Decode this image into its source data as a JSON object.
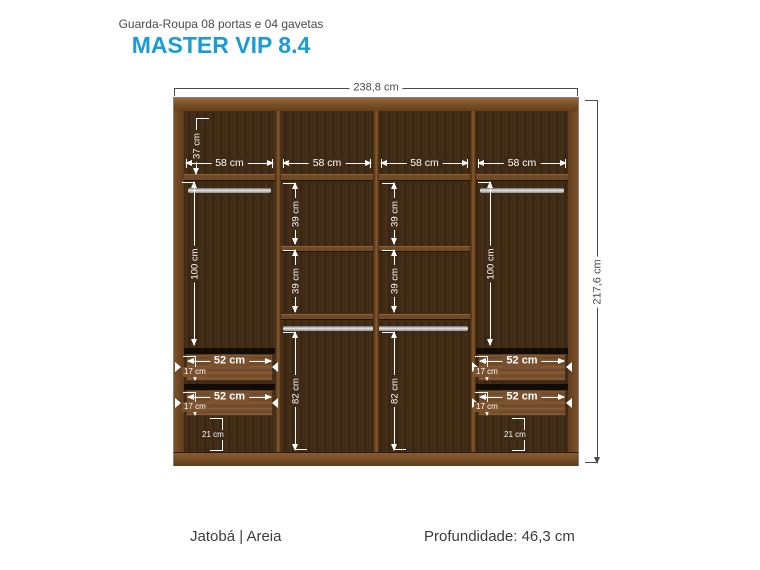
{
  "header": {
    "subtitle": "Guarda-Roupa 08 portas e 04 gavetas",
    "title": "MASTER VIP 8.4"
  },
  "overall": {
    "width_label": "238,8 cm",
    "height_label": "217,6 cm"
  },
  "interior": {
    "top_shelf_label": "37 cm",
    "section_width_labels": [
      "58 cm",
      "58 cm",
      "58 cm",
      "58 cm"
    ],
    "hang_labels": [
      "100 cm",
      "100 cm"
    ],
    "shelf_gap_labels": [
      "39 cm",
      "39 cm",
      "39 cm",
      "39 cm"
    ],
    "lower_gap_labels": [
      "82 cm",
      "82 cm"
    ],
    "drawer_width_labels": [
      "52 cm",
      "52 cm",
      "52 cm",
      "52 cm"
    ],
    "drawer_height_labels": [
      "17 cm",
      "17 cm",
      "17 cm",
      "17 cm"
    ],
    "base_gap_labels": [
      "21 cm",
      "21 cm"
    ]
  },
  "footer": {
    "finish": "Jatobá | Areia",
    "depth": "Profundidade: 46,3 cm"
  },
  "colors": {
    "accent": "#1a9cd4",
    "frame_wood": "#6f4a26",
    "interior_wood": "#3f2a16",
    "drawer_wood": "#7b5230",
    "hardware_gray": "#c0c0c0",
    "dim_inside": "#ffffff",
    "dim_outside": "#4a4a4a"
  }
}
